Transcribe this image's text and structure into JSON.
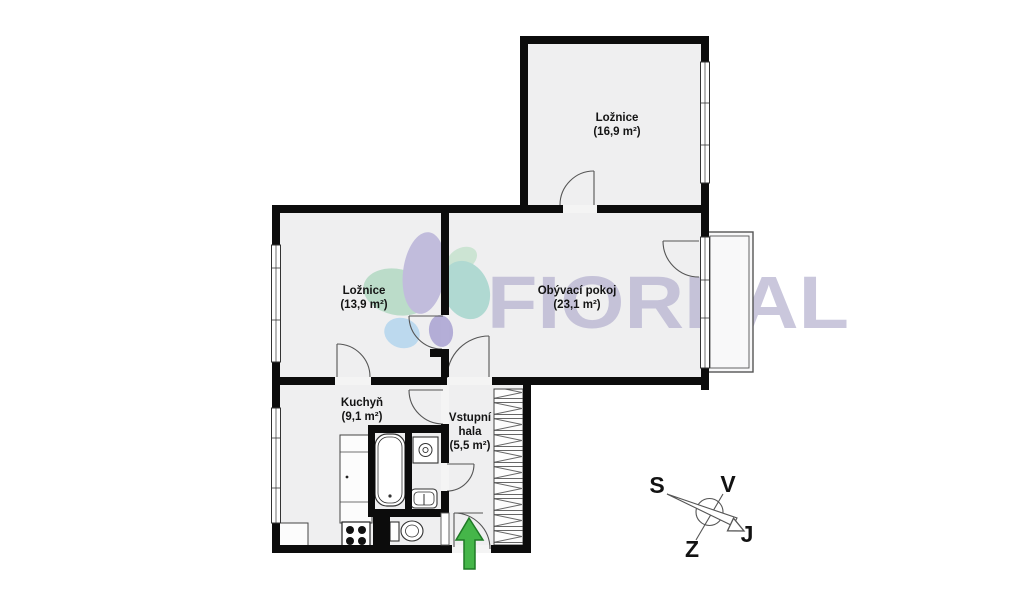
{
  "document": {
    "kind": "apartment-floor-plan"
  },
  "rooms": [
    {
      "id": "bedroom-top",
      "name": "Ložnice",
      "area": "(16,9 m²)"
    },
    {
      "id": "bedroom-left",
      "name": "Ložnice",
      "area": "(13,9 m²)"
    },
    {
      "id": "living-room",
      "name": "Obývací pokoj",
      "area": "(23,1 m²)"
    },
    {
      "id": "kitchen",
      "name": "Kuchyň",
      "area": "(9,1 m²)"
    },
    {
      "id": "entry-hall",
      "name": "Vstupní",
      "name2": "hala",
      "area": "(5,5 m²)"
    }
  ],
  "compass": {
    "north": "S",
    "east": "V",
    "west": "Z",
    "south": "J"
  },
  "watermark": {
    "brand": "FIOREAL",
    "color": "#b2afce",
    "petal_colors": [
      "#b2d9c3",
      "#b9b4d9",
      "#a6d6cd",
      "#b4d6ee",
      "#a9a2d2",
      "#c6e3cf"
    ]
  },
  "entrance_arrow": {
    "fill": "#45b649",
    "border": "#1f7a26"
  },
  "plan_colors": {
    "wall": "#0c0c0c",
    "floor": "#efeff0",
    "thin_line": "#555555"
  },
  "fixture_icons": [
    "bathtub",
    "washing-machine",
    "sink",
    "toilet",
    "stove",
    "kitchen-counter",
    "built-in-wardrobe",
    "balcony",
    "window",
    "door-swing"
  ]
}
